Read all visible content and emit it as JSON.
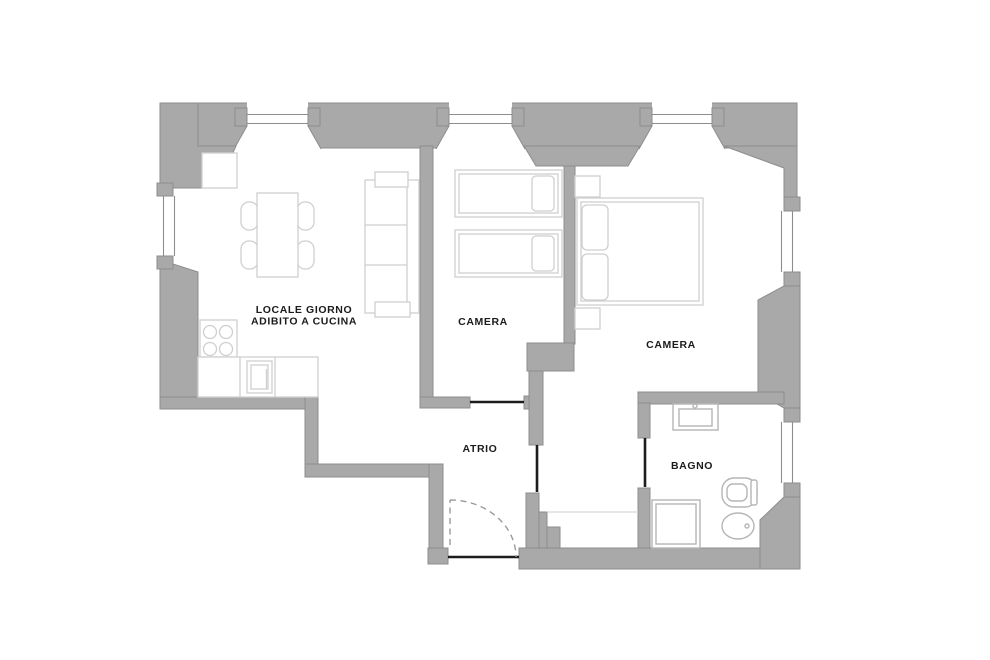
{
  "plan_type": "apartment-floor-plan",
  "rooms": [
    {
      "id": "living-kitchen",
      "label_lines": [
        "LOCALE GIORNO",
        "ADIBITO A CUCINA"
      ]
    },
    {
      "id": "bedroom-1",
      "label_lines": [
        "CAMERA"
      ]
    },
    {
      "id": "bedroom-2",
      "label_lines": [
        "CAMERA"
      ]
    },
    {
      "id": "hall",
      "label_lines": [
        "ATRIO"
      ]
    },
    {
      "id": "bathroom",
      "label_lines": [
        "BAGNO"
      ]
    }
  ],
  "furniture_items": [
    "corner-cabinet",
    "dining-table",
    "dining-chair",
    "sofa",
    "cooktop",
    "oven",
    "kitchen-counter",
    "single-bed",
    "single-bed",
    "double-bed",
    "nightstand",
    "washbasin",
    "shower",
    "toilet",
    "bidet"
  ],
  "colors": {
    "background": "#ffffff",
    "wall": "#a9a9a9",
    "wall_outline": "#8d8d8d",
    "furniture": "#cfcfcf",
    "fixture": "#b5b5b5",
    "door": "#1c1c1c",
    "swing": "#9a9a9a",
    "label": "#1b1b1b",
    "faint": "#dedede"
  }
}
